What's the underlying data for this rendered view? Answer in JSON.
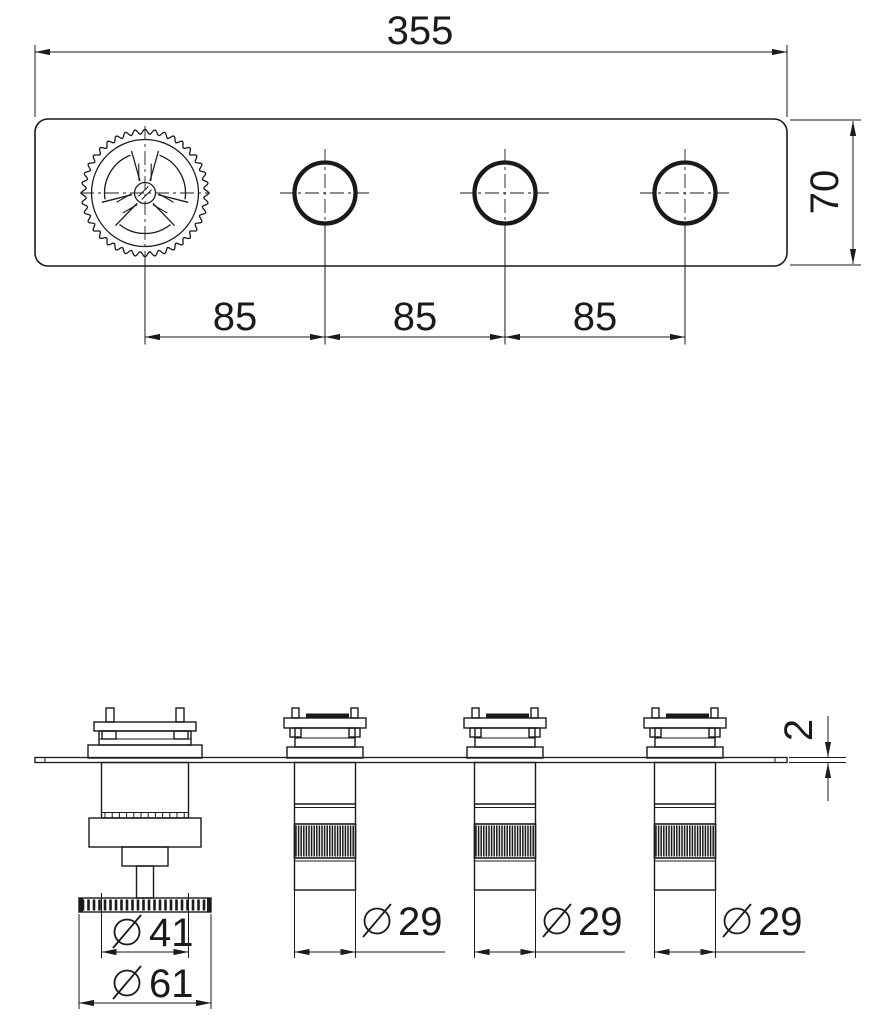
{
  "drawing": {
    "title": "valve-trim-technical-drawing",
    "dims": {
      "overall_width": "355",
      "plate_height": "70",
      "spacing": [
        "85",
        "85",
        "85"
      ],
      "plate_thickness": "2",
      "thermostat_inner_dia": "41",
      "thermostat_outer_dia": "61",
      "knob_dia": [
        "29",
        "29",
        "29"
      ],
      "diameter_symbol": "⌀"
    },
    "colors": {
      "line": "#1a1a1a",
      "background": "#ffffff"
    }
  }
}
